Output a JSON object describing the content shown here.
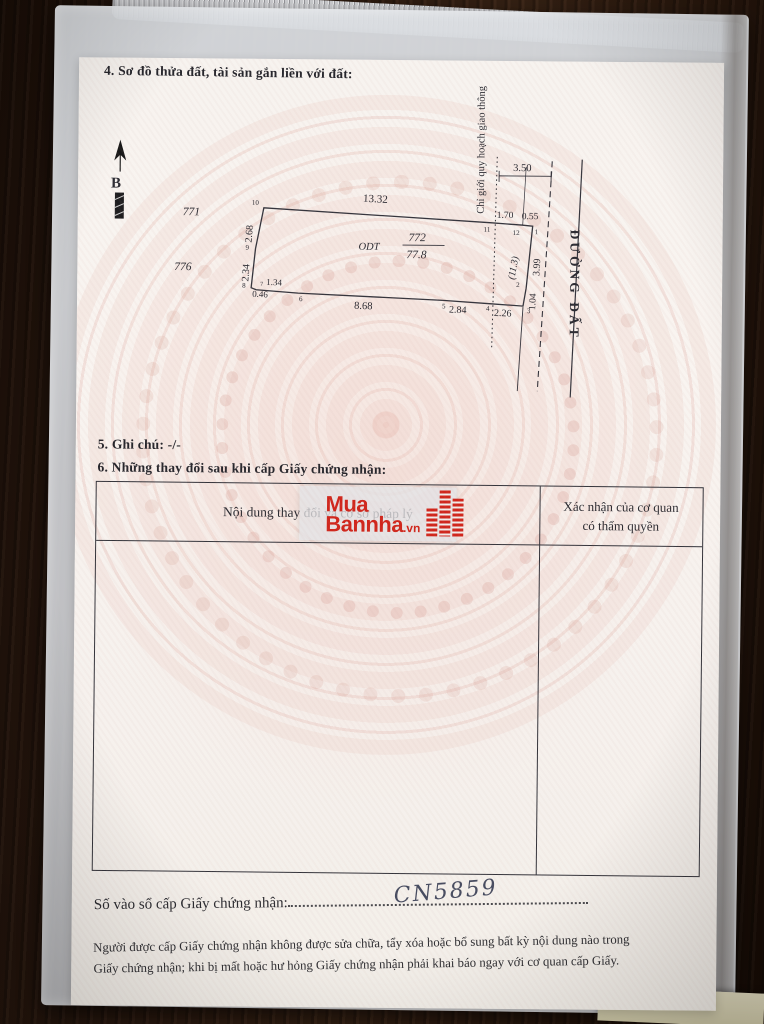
{
  "photo": {
    "colors": {
      "table_wood": "#2b1a10",
      "sleeve": "#d3d5d8",
      "paper": "#f9f5f1",
      "watermark_pink": "#dfa79a",
      "ink": "#2e2e33",
      "logo_red": "#d0261c",
      "handwriting_ink": "#474c60"
    }
  },
  "certificate": {
    "section4_title": "4. Sơ đồ thửa đất, tài sản gắn liền với đất:",
    "section5_line": "5. Ghi chú: -/-",
    "section6_title": "6. Những thay đổi sau khi cấp Giấy chứng nhận:",
    "table": {
      "col1_header": "Nội dung thay đổi và cơ sở pháp lý",
      "col2_header_line1": "Xác nhận của cơ quan",
      "col2_header_line2": "có thẩm quyền"
    },
    "serial_label": "Số vào sổ cấp Giấy chứng nhận:",
    "serial_value": "CN5859",
    "footer_line1": "Người được cấp Giấy chứng nhận không được sửa chữa, tẩy xóa hoặc bổ sung bất kỳ nội dung nào trong",
    "footer_line2": "Giấy chứng nhận; khi bị mất hoặc hư hỏng Giấy chứng nhận phải khai báo ngay với cơ quan cấp Giấy."
  },
  "diagram": {
    "north_label": "B",
    "parcel_left_top": "771",
    "parcel_left_bottom": "776",
    "land_use_code": "ODT",
    "parcel_number": "772",
    "area": "77.8",
    "planning_note": "Chỉ giới quy hoạch giao thông",
    "road_label": "ĐƯỜNG ĐẤT",
    "dims": {
      "top": "13.32",
      "left_upper": "2.68",
      "left_lower": "2.34",
      "bottom_jog_a": "0.46",
      "bottom_jog_b": "1.34",
      "bottom_main": "8.68",
      "bottom_mid": "2.84",
      "bottom_right": "2.26",
      "top_right_a": "1.70",
      "top_right_b": "0.55",
      "road_span": "3.50",
      "right_upper": "3.99",
      "right_lower": "1.04",
      "planning_depth": "(11.3)"
    },
    "vertices": {
      "v1": "1",
      "v2": "2",
      "v3": "3",
      "v4": "4",
      "v5": "5",
      "v6": "6",
      "v7": "7",
      "v8": "8",
      "v9": "9",
      "v10": "10",
      "v11": "11",
      "v12": "12"
    }
  },
  "watermark_logo": {
    "line1": "Mua",
    "line2": "Bannha",
    "suffix": ".vn"
  }
}
